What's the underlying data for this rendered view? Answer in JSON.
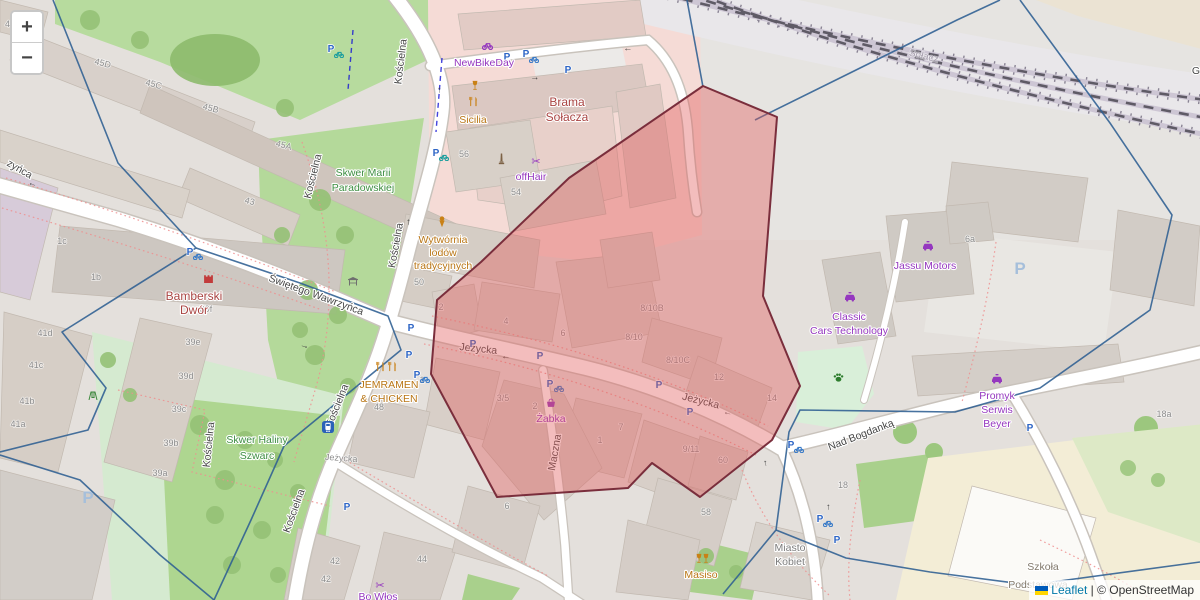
{
  "controls": {
    "zoom_in": "+",
    "zoom_out": "−"
  },
  "attribution": {
    "flag_icon": "ukraine-flag",
    "leaflet": "Leaflet",
    "sep": "|",
    "osm": "© OpenStreetMap"
  },
  "streets": {
    "koscielna": "Kościelna",
    "swietego_wawrzynca": "Świętego Wawrzyńca",
    "wawrzynca_partial": "zyńca",
    "jezycka": "Jeżycka",
    "nad_bogdanka": "Nad Bogdanką",
    "maczna": "Maczna",
    "solacz": "Sołacz",
    "partial_right": "G"
  },
  "pois": {
    "newbikeday": "NewBikeDay",
    "brama1": "Brama",
    "brama2": "Sołacza",
    "sicilia": "Sicilia",
    "offhair": "offHair",
    "wytwornia1": "Wytwórnia",
    "wytwornia2": "lodów",
    "wytwornia3": "tradycyjnych",
    "bamberski1": "Bamberski",
    "bamberski2": "Dwór",
    "skwer_marii1": "Skwer Marii",
    "skwer_marii2": "Paradowskiej",
    "skwer_haliny1": "Skwer Haliny",
    "skwer_haliny2": "Szwarc",
    "jemramen1": "JEMRAMEN",
    "jemramen2": "& CHICKEN",
    "zabka": "Żabka",
    "jassu": "Jassu Motors",
    "classic1": "Classic",
    "classic2": "Cars Technology",
    "promyk1": "Promyk",
    "promyk2": "Serwis",
    "promyk3": "Beyer",
    "miasto1": "Miasto",
    "miasto2": "Kobiet",
    "masiso": "Masiso",
    "bo_wlos": "Bo Włos",
    "szkola1": "Szkoła",
    "szkola2": "Podstawowa"
  },
  "houses": [
    "45",
    "45D",
    "45C",
    "45B",
    "45A",
    "43",
    "1c",
    "1b",
    "39f",
    "39e",
    "39d",
    "39c",
    "39b",
    "39a",
    "41d",
    "41c",
    "41b",
    "41a",
    "56",
    "54",
    "50",
    "2",
    "4",
    "6",
    "8/10B",
    "8/10",
    "8/10C",
    "12",
    "14",
    "3/5",
    "2",
    "48",
    "1",
    "1",
    "7",
    "9/11",
    "60",
    "58",
    "6",
    "42",
    "42",
    "44",
    "6a",
    "18",
    "18a"
  ],
  "icons": {
    "parking": "P",
    "scissors": "✂",
    "arrow_right": "→",
    "arrow_left": "←"
  },
  "colors": {
    "overlay_fill": "#e25b5b",
    "overlay_stroke": "#7a2e3c",
    "boundary": "#2d5f92",
    "shop_label": "#9537bf",
    "food_label": "#b97514",
    "park_label": "#3d8e41",
    "landmark_label": "#a94442",
    "road": "#ffffff",
    "park_green": "#b4d99a",
    "building_gray": "#d6cec6",
    "retail_pink": "#f5dbd6"
  }
}
